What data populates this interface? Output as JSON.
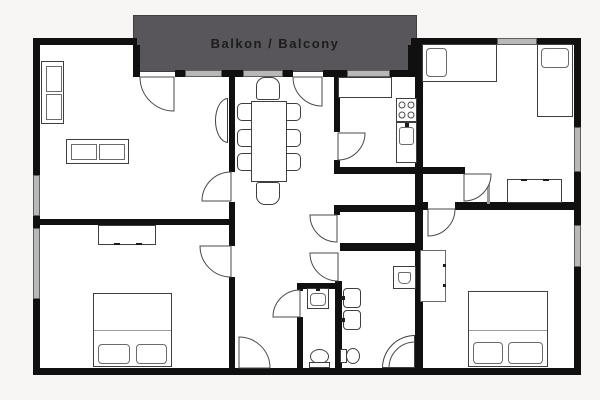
{
  "balcony": {
    "label": "Balkon / Balcony"
  },
  "colors": {
    "page_background": "#f7f6f4",
    "floor": "#ffffff",
    "walls": "#101010",
    "windows": "#b8b8b8",
    "balcony_fill": "#58565a",
    "balcony_text": "#1c1c1c",
    "furniture_outline": "#3e3e3e",
    "door_swing": "#4a4a4a"
  },
  "legend": {
    "fixtures": [
      "sofa",
      "console-table",
      "dining-table",
      "dining-chair",
      "kitchen-counter",
      "stove",
      "kitchen-sink",
      "single-bed",
      "double-bed",
      "pillow",
      "dresser",
      "wardrobe",
      "washbasin",
      "toilet",
      "corner-shower",
      "washing-machine",
      "entrance-door",
      "interior-door",
      "window",
      "wall"
    ]
  }
}
